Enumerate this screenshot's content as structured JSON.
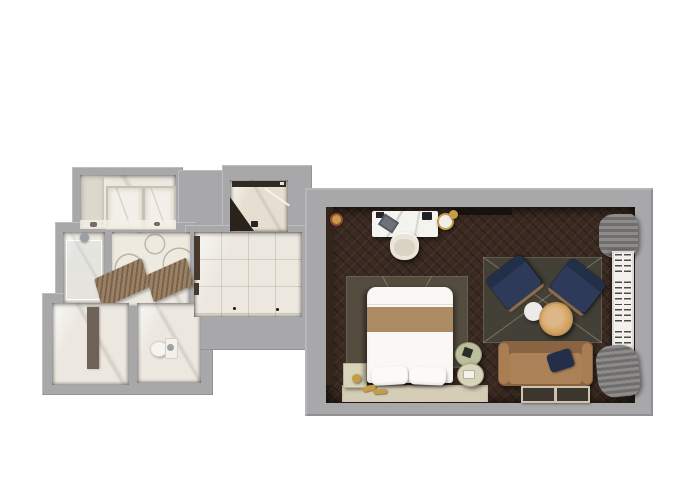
{
  "palette": {
    "background": "#ffffff",
    "wall": "#a8a8ab",
    "marble": "#ece8e0",
    "marbleLight": "#f3f0e9",
    "marbleDark": "#ded8cc",
    "woodFloor": "#3a2a21",
    "darkPanel": "#33251c",
    "rugDark": "#544c3f",
    "rugSitting": "#434038",
    "beigeRug": "#d6cdb7",
    "bedWhite": "#f9f8f4",
    "bedBand": "#ac8a63",
    "navy": "#2e3a5a",
    "navyDark": "#232e49",
    "woodTrim": "#8d6c49",
    "oak": "#d2a05e",
    "sofa": "#ab8157",
    "sofaBack": "#8a6442",
    "sofaArm": "#a87e52",
    "sage": "#bcbf9e",
    "sageLight": "#d8d4b9",
    "gold": "#c59c48",
    "cream": "#e9e5da",
    "creamDark": "#d9d3c4",
    "curtain": "#6f6e6c",
    "curtainLight": "#8d8c8a",
    "shutter": "#f2f1ed",
    "slat": "#4e4b46",
    "chrome": "#9aa0a4",
    "fixtureDark": "#17120e",
    "accentRing": "#9c4a2f"
  },
  "labels": {
    "scene": "3D rendered floor plan of a hotel suite",
    "bathroom": "Marble bathroom",
    "showerCabin": "Shower cabin",
    "vanity": "Vanity area with mosaic wall",
    "walkInShower": "Walk-in shower",
    "toiletRoom": "Toilet room",
    "toilet": "Toilet",
    "wardrobe": "Wardrobe nook",
    "mirror": "Leaning mirror",
    "hallway": "Entry hallway",
    "bedroom": "Bedroom and lounge",
    "woodFloor": "Dark herringbone wood floor",
    "desk": "Marble writing desk",
    "laptop": "Laptop",
    "deskChair": "Desk chair",
    "tv": "Wall-mounted TV",
    "trayTable": "Round tray table",
    "bedRug": "Dark area rug under bed",
    "beigeRug": "Beige runner rug",
    "bed": "Double bed with tan throw",
    "pillow": "Pillow",
    "nightstand": "Nightstand with brass lamp",
    "slippers": "Slippers",
    "sideTable": "Round green side table",
    "sittingRug": "Patterned lounge rug",
    "armchair": "Navy lounge armchair",
    "coffeeTableWhite": "White side table",
    "coffeeTableOak": "Oak coffee table",
    "sofa": "Tan sofa",
    "sofaPillow": "Navy throw pillow",
    "floorMat": "Floor mat",
    "window": "Shuttered window",
    "curtain": "Gray curtain",
    "bathMat": "Wooden bath mat",
    "showerHead": "Shower fixture",
    "redButton": "Wall fixture"
  }
}
